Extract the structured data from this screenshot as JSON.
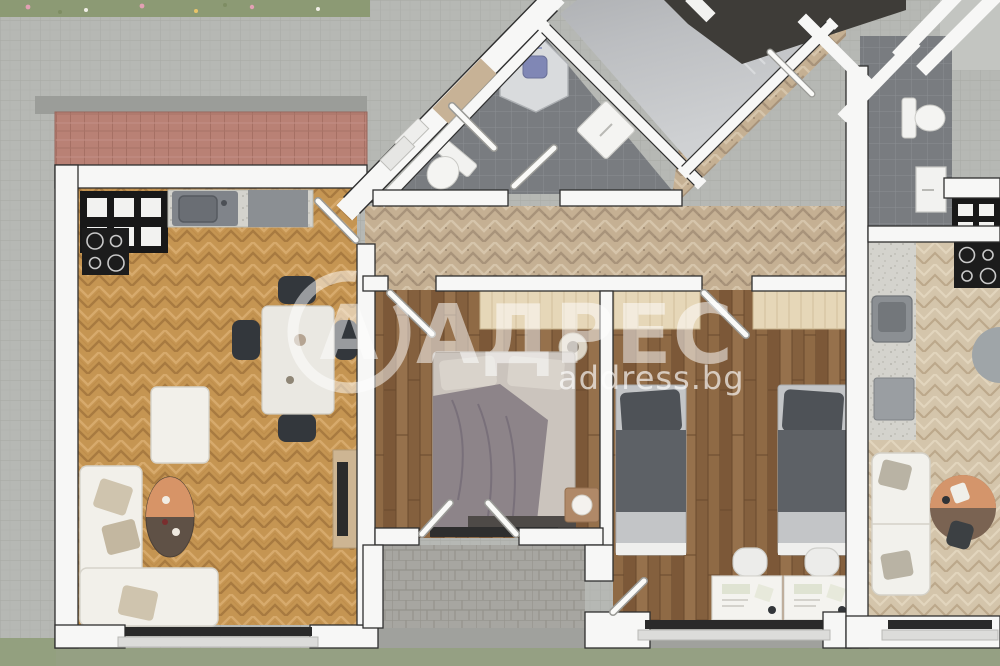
{
  "watermark": {
    "logo_letter": "А",
    "title": "АДРЕС",
    "subtitle": "address.bg",
    "color": "#ffffff"
  },
  "palette": {
    "wall": "#f7f7f6",
    "wall_edge": "#2f2f2f",
    "pavers": "#b6b8b4",
    "grass": "#95a083",
    "roof_tiles": "#b98175",
    "kitchen_floor": "#c79757",
    "hallway_floor": "#c7b296",
    "bedroom_floor": "#8d6743",
    "bathroom_tile": "#797c80",
    "stair_concrete": "#b9bbbd",
    "terrace_stone": "#a7a6a1",
    "shower_fixture": "#8087b5"
  },
  "plan": {
    "type": "apartment-floor-plan-top-view",
    "rooms": [
      {
        "name": "living-room-with-kitchen",
        "floor": "oak-herringbone"
      },
      {
        "name": "hallway",
        "floor": "tan-herringbone"
      },
      {
        "name": "master-bedroom",
        "floor": "walnut-planks"
      },
      {
        "name": "kids-bedroom",
        "floor": "walnut-planks"
      },
      {
        "name": "bathroom",
        "floor": "dark-gray-tile"
      },
      {
        "name": "stairwell",
        "floor": "concrete"
      },
      {
        "name": "terrace",
        "floor": "stone-pavers"
      },
      {
        "name": "neighbor-bathroom",
        "floor": "dark-gray-tile"
      },
      {
        "name": "neighbor-kitchen-living",
        "floor": "light-herringbone"
      }
    ],
    "objects": [
      "kitchen-window",
      "kitchen-sink",
      "cooktop",
      "kitchen-counter",
      "dining-table",
      "dining-chairs",
      "corner-sofa",
      "coffee-table",
      "tv-console",
      "entry-door",
      "entry-steps",
      "double-bed",
      "wardrobe",
      "nightstand-lamp",
      "french-doors",
      "single-bed-left",
      "single-bed-right",
      "desk-left",
      "desk-right",
      "desk-chairs",
      "shower-cabin",
      "toilet",
      "washing-machine",
      "stair-treads",
      "neighbor-sofa",
      "neighbor-round-table"
    ]
  }
}
